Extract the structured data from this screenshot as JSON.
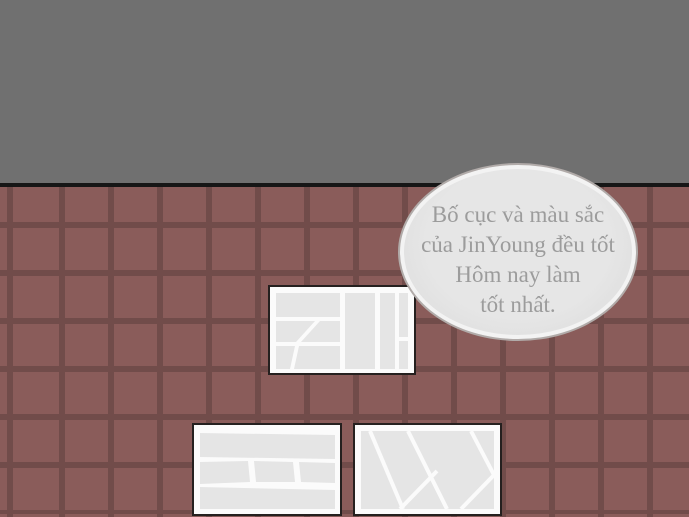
{
  "scene": {
    "type": "comic-panel",
    "speech_bubble": {
      "lines": {
        "0": "Bố cục và màu sắc",
        "1": "của JinYoung đều tốt",
        "2": "Hôm nay làm",
        "3": "tốt nhất."
      }
    },
    "objects": {
      "pages_on_wall": "3 comic manuscript pages with empty panel layouts",
      "wall_top": "plain gray upper wall",
      "wall_bottom": "dark red-brown square tile wall"
    },
    "colors": {
      "wall_top": "#707070",
      "divider_rail": "#161616",
      "tile": "#8a5c5a",
      "tile_grout": "#714c4a",
      "bubble_fill": "#e2e2e2",
      "bubble_border": "#b1aba9",
      "bubble_text": "#9c9c9c",
      "page_background": "#fbfbfb",
      "page_border": "#25201f",
      "panel_fill": "#e5e5e5"
    }
  }
}
